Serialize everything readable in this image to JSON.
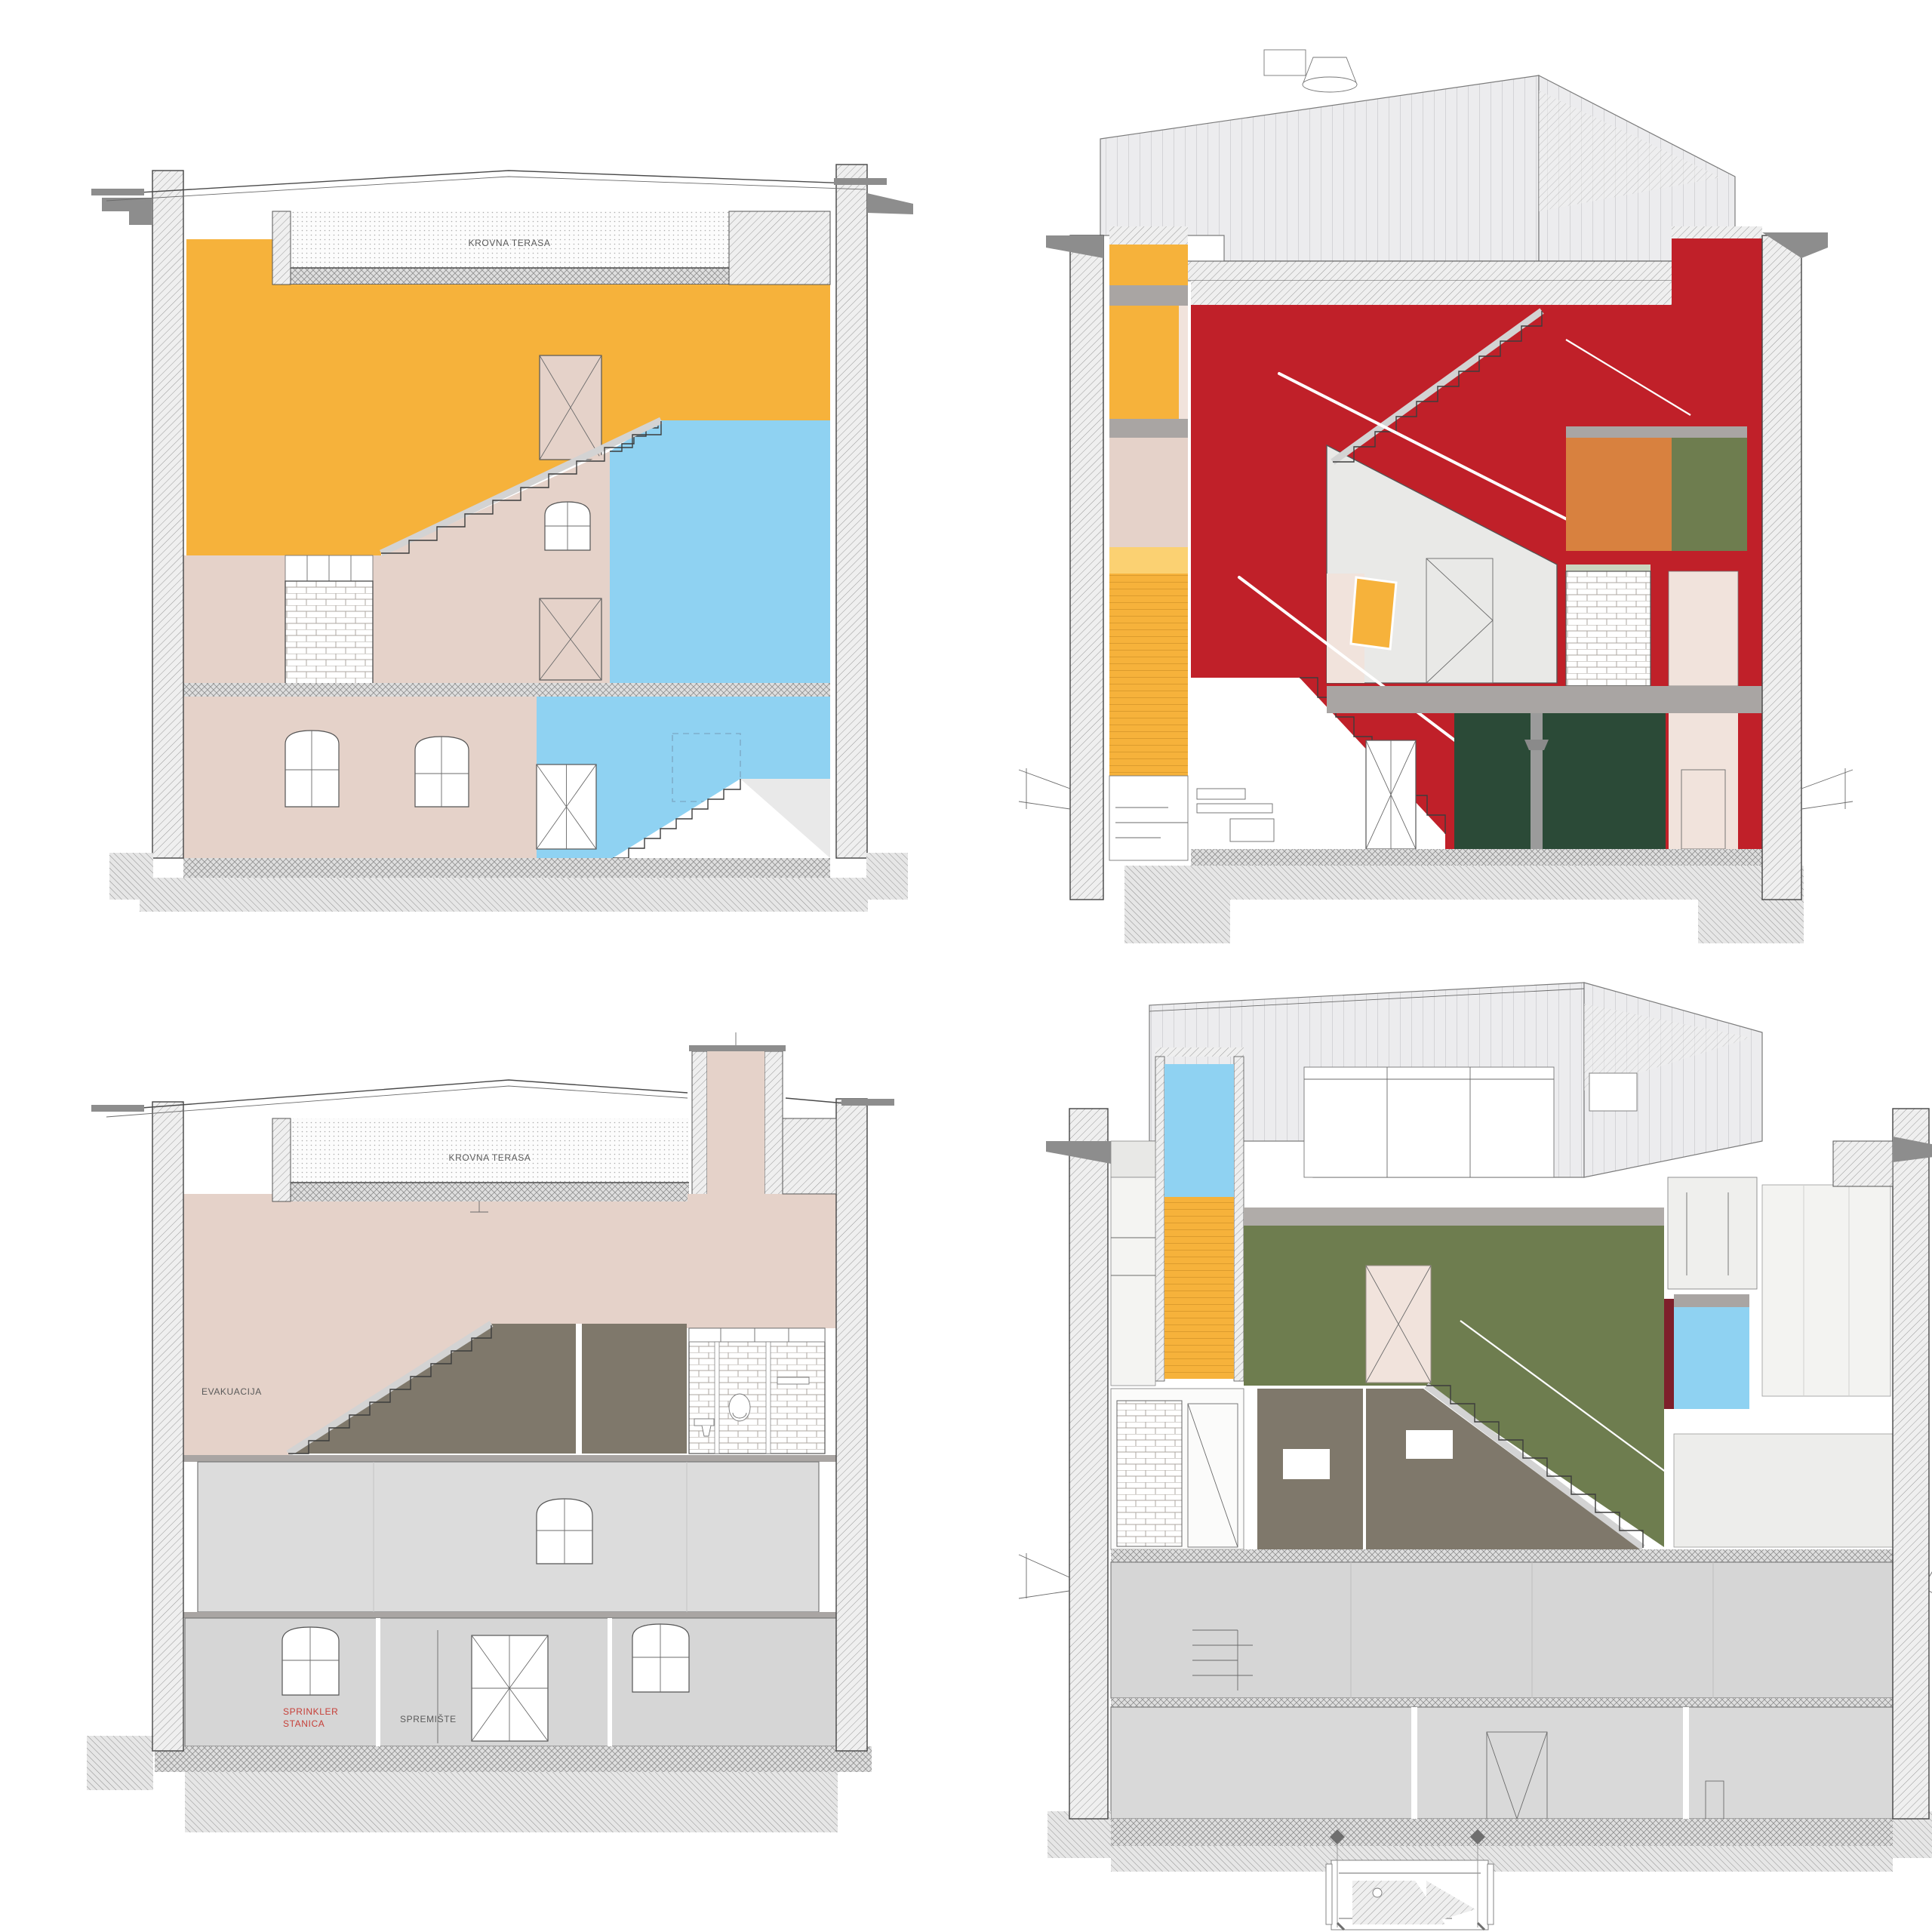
{
  "drawing": {
    "type": "architectural-cross-sections",
    "layout": "2x2 grid of colored building section drawings",
    "sections": {
      "top_left": {
        "labels": {
          "roof_terrace": "KROVNA TERASA"
        }
      },
      "top_right": {
        "labels": {}
      },
      "bottom_left": {
        "labels": {
          "roof_terrace": "KROVNA TERASA",
          "evacuation": "EVAKUACIJA",
          "sprinkler_line1": "SPRINKLER",
          "sprinkler_line2": "STANICA",
          "storage": "SPREMIŠTE"
        }
      },
      "bottom_right": {
        "labels": {}
      }
    }
  },
  "palette": {
    "yellow": "#F6B23B",
    "yellow_light": "#FBD172",
    "blue": "#8FD2F2",
    "red": "#C02029",
    "maroon": "#7E1F2B",
    "rose": "#E5D2C9",
    "rose_pale": "#F1E3DC",
    "orange": "#D8813F",
    "olive": "#6E7D4F",
    "forest": "#2B4A37",
    "taupe": "#7F786B",
    "slab_gray": "#A9A5A3",
    "floor_gray": "#D6D6D6",
    "roof_gray": "#ECECEE",
    "label_gray": "#5a5a5a",
    "label_red": "#C63F38"
  }
}
